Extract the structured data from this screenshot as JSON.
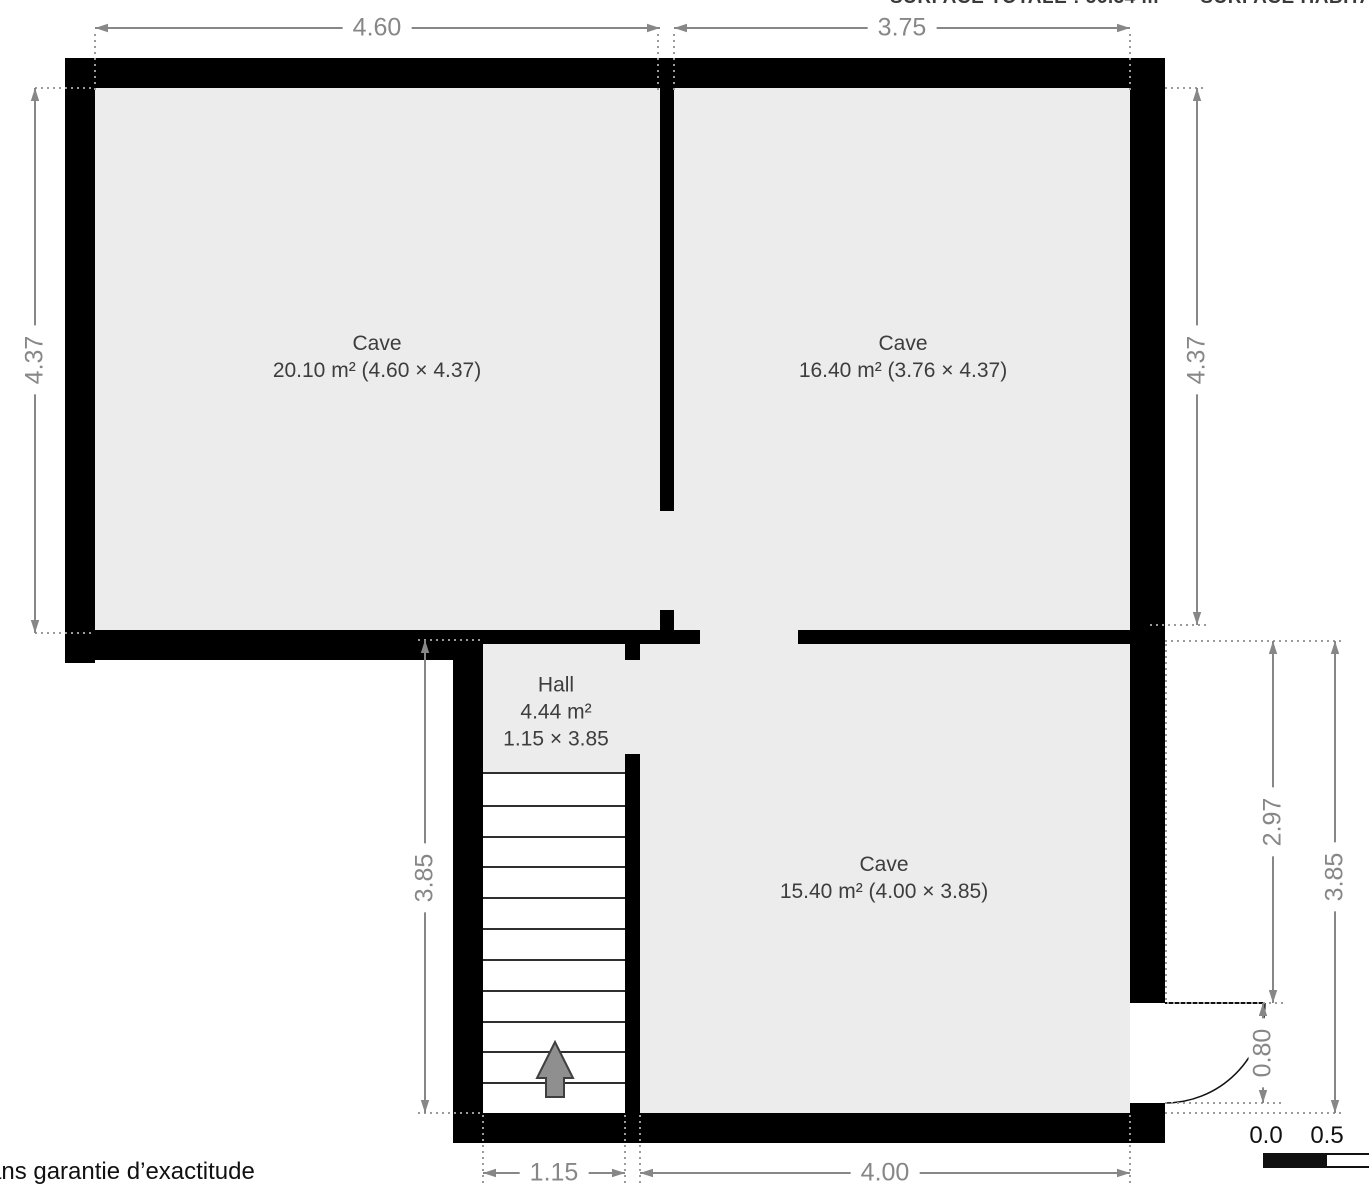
{
  "title_bar": {
    "surface_summary": "SURFACE TOTALE : 56.34 m²      SURFACE HABITABLE"
  },
  "rooms": [
    {
      "name": "Cave",
      "details": "20.10 m² (4.60 × 4.37)"
    },
    {
      "name": "Cave",
      "details": "16.40 m² (3.76 × 4.37)"
    },
    {
      "name": "Hall",
      "area": "4.44 m²",
      "size": "1.15 × 3.85"
    },
    {
      "name": "Cave",
      "details": "15.40 m² (4.00 × 3.85)"
    }
  ],
  "dimensions": {
    "top_left": "4.60",
    "top_right": "3.75",
    "left_upper": "4.37",
    "right_upper": "4.37",
    "left_lower": "3.85",
    "right_inner": "2.97",
    "door": "0.80",
    "right_outer": "3.85",
    "bottom_left": "1.15",
    "bottom_right": "4.00"
  },
  "stairs": {
    "treads": 11,
    "direction": "up"
  },
  "scale_bar": {
    "start": "0.0",
    "half": "0.5"
  },
  "footer": {
    "disclaimer": "sans garantie d’exactitude"
  },
  "colors": {
    "wall": "#000000",
    "floor": "#ececec",
    "dimension": "#878787",
    "label": "#3d3d3d"
  }
}
